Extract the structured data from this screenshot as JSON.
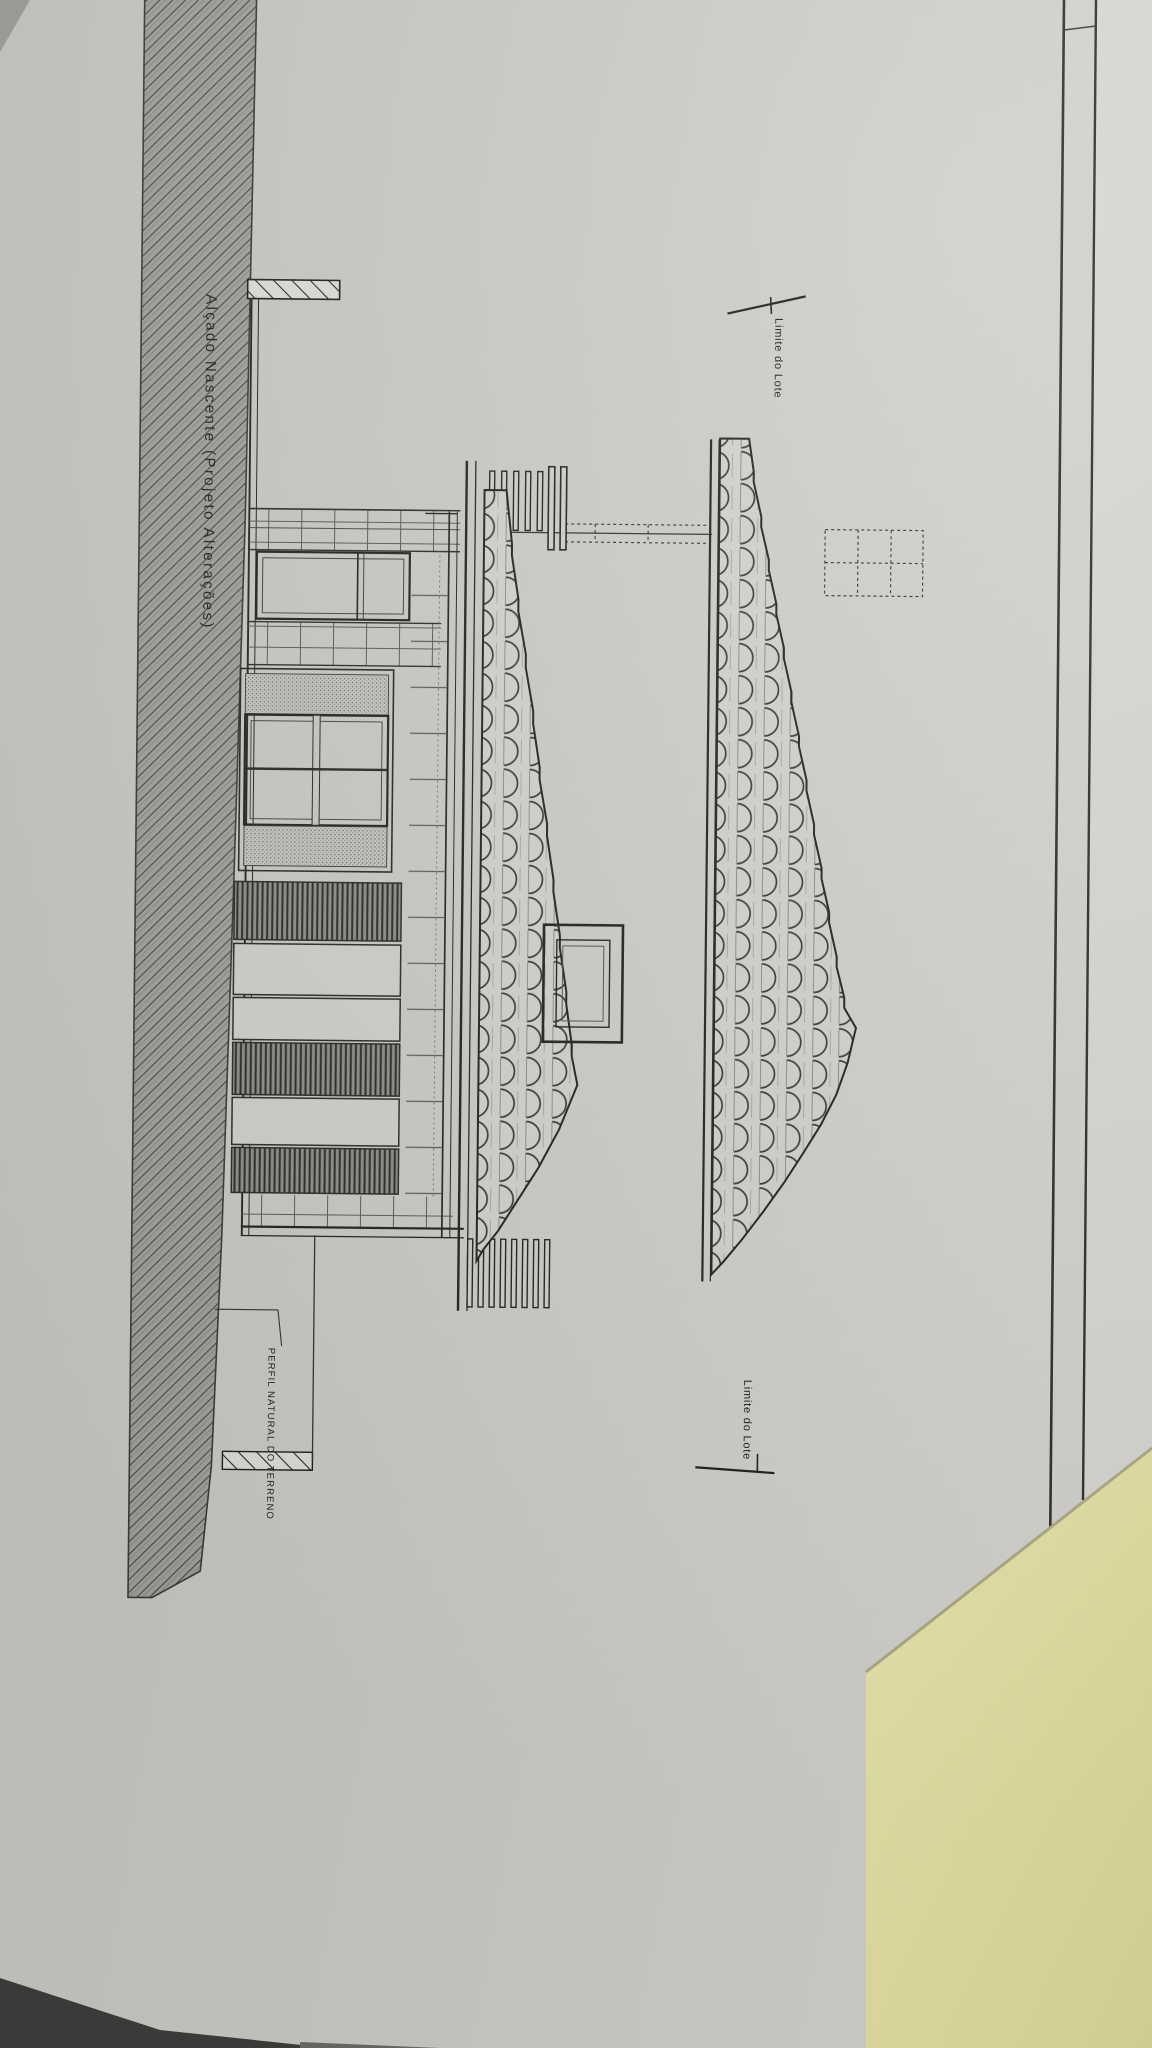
{
  "drawing": {
    "title": "Alçado Nascente (Projeto Alterações)",
    "labels": {
      "lot_limit_top": "Limite do Lote",
      "lot_limit_bottom": "Limite do Lote",
      "terrain_profile": "PERFIL NATURAL DO TERRENO"
    }
  },
  "colors": {
    "paper": "#cbcac5",
    "paper_light": "#d6d5d0",
    "ink": "#2a2a28",
    "section_band": "#a2a19c",
    "band_hatch": "#4e4e4a",
    "sticky_note": "#e8e4a9",
    "note_edge": "#aeab83",
    "table_dark": "#3f3e3c"
  }
}
